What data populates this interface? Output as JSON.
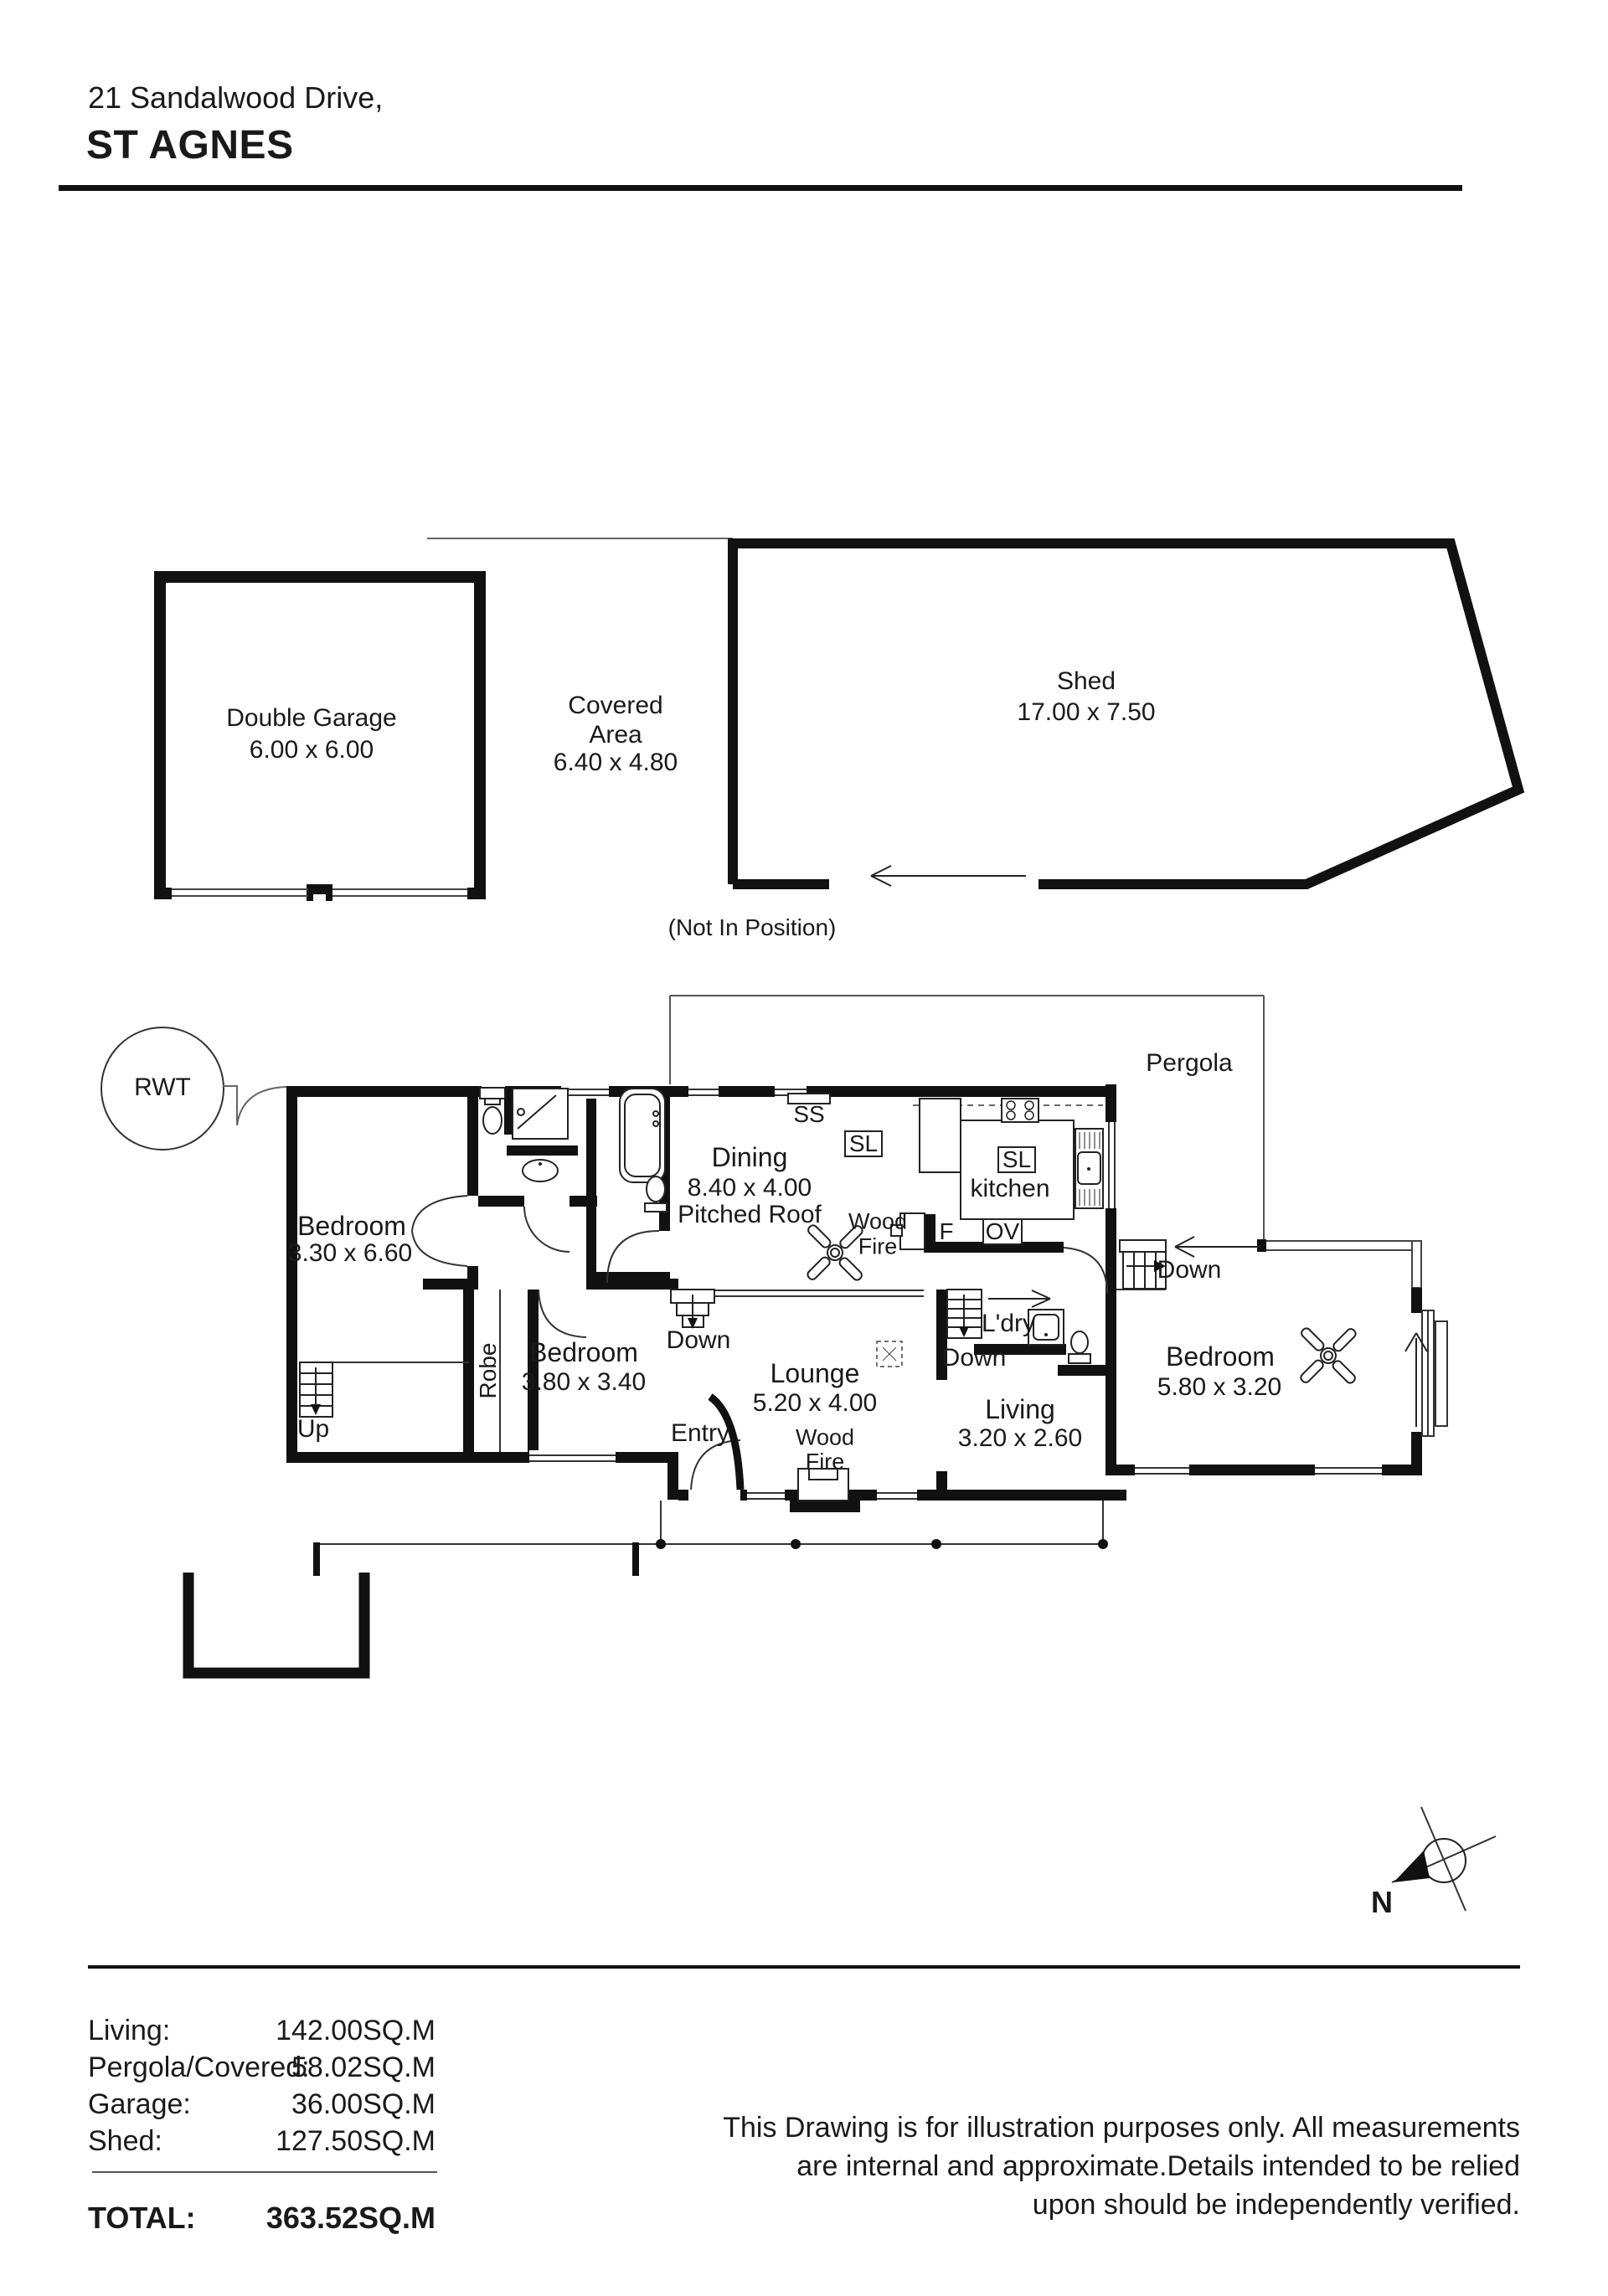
{
  "header": {
    "address_line": "21 Sandalwood Drive,",
    "suburb": "ST AGNES"
  },
  "outbuildings": {
    "garage": {
      "name": "Double Garage",
      "dims": "6.00 x 6.00"
    },
    "covered": {
      "line1": "Covered",
      "line2": "Area",
      "dims": "6.40 x 4.80"
    },
    "shed": {
      "name": "Shed",
      "dims": "17.00 x 7.50"
    },
    "position_note": "(Not In Position)"
  },
  "site": {
    "rwt": "RWT",
    "pergola": "Pergola",
    "north": "N"
  },
  "rooms": {
    "bedroom1": {
      "name": "Bedroom",
      "dims": "3.30 x 6.60"
    },
    "bedroom2": {
      "name": "Bedroom",
      "dims": "3.80 x 3.40"
    },
    "bedroom3": {
      "name": "Bedroom",
      "dims": "5.80 x 3.20"
    },
    "dining": {
      "name": "Dining",
      "dims": "8.40 x 4.00",
      "note": "Pitched Roof"
    },
    "kitchen": {
      "name": "kitchen"
    },
    "lounge": {
      "name": "Lounge",
      "dims": "5.20 x 4.00"
    },
    "living": {
      "name": "Living",
      "dims": "3.20 x 2.60"
    },
    "laundry": {
      "name": "L'dry"
    },
    "robe": {
      "name": "Robe"
    },
    "entry": {
      "name": "Entry"
    }
  },
  "annotations": {
    "up": "Up",
    "down": "Down",
    "wood": "Wood",
    "fire": "Fire",
    "ss": "SS",
    "sl": "SL",
    "ov": "OV",
    "f": "F"
  },
  "icons": {
    "ceiling_fan": "fan-x-symbol",
    "compass": "north-arrow",
    "stairs": "stair-treads",
    "fixtures": [
      "toilet",
      "shower",
      "bath",
      "vanity",
      "sink",
      "stove",
      "laundry-tub",
      "fireplace",
      "vent"
    ]
  },
  "summary": {
    "rows": [
      {
        "label": "Living:",
        "value": "142.00SQ.M"
      },
      {
        "label": "Pergola/Covered:",
        "value": "58.02SQ.M"
      },
      {
        "label": "Garage:",
        "value": "36.00SQ.M"
      },
      {
        "label": "Shed:",
        "value": "127.50SQ.M"
      }
    ],
    "total_label": "TOTAL:",
    "total_value": "363.52SQ.M"
  },
  "disclaimer": {
    "line1": "This Drawing is for illustration purposes only. All measurements",
    "line2": "are internal and approximate.Details intended to be relied",
    "line3": "upon should be independently verified."
  }
}
